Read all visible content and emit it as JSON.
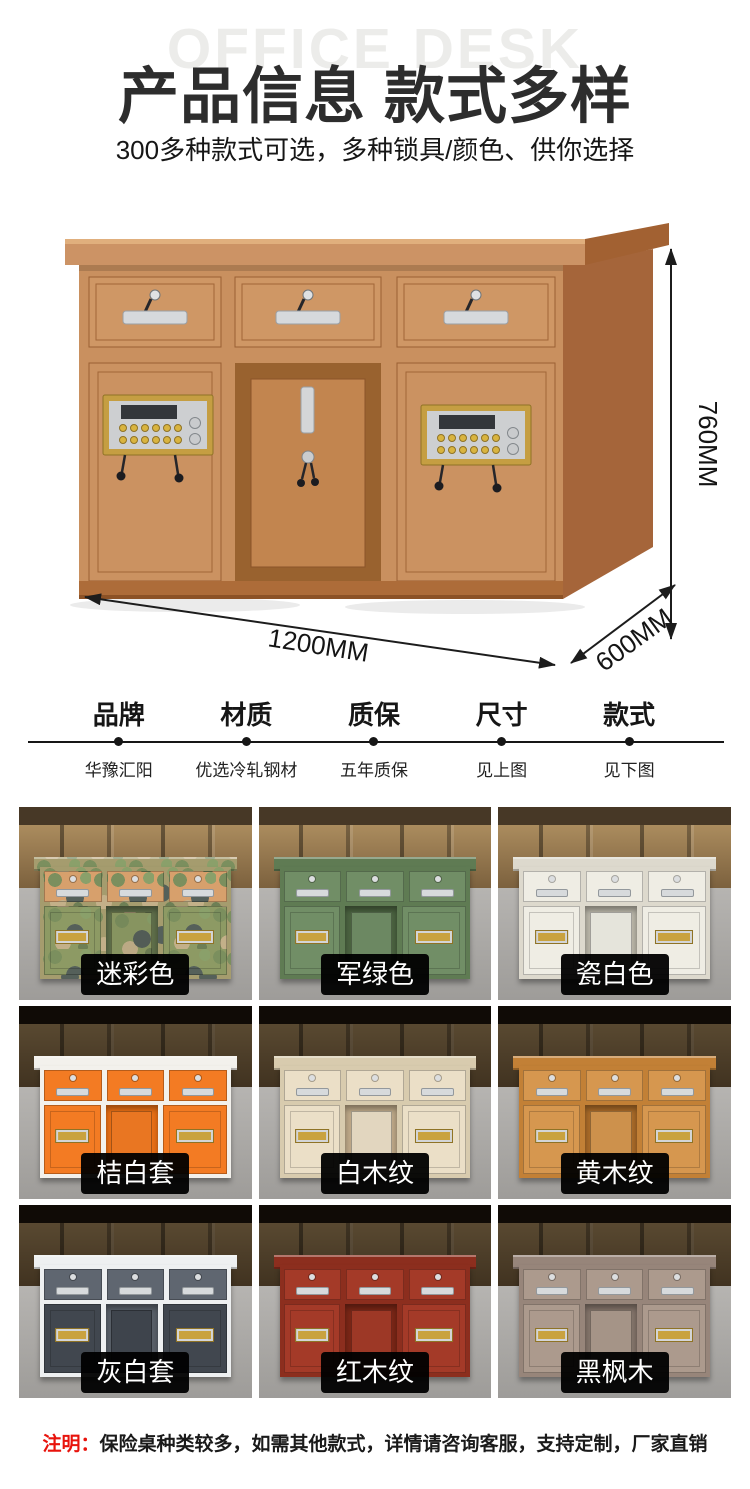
{
  "watermark": "OFFICE DESK",
  "header": {
    "title": "产品信息 款式多样",
    "subtitle": "300多种款式可选，多种锁具/颜色、供你选择"
  },
  "hero": {
    "height_label": "760MM",
    "width_label": "1200MM",
    "depth_label": "600MM"
  },
  "specs": [
    {
      "label": "品牌",
      "value": "华豫汇阳"
    },
    {
      "label": "材质",
      "value": "优选冷轧钢材"
    },
    {
      "label": "质保",
      "value": "五年质保"
    },
    {
      "label": "尺寸",
      "value": "见上图"
    },
    {
      "label": "款式",
      "value": "见下图"
    }
  ],
  "variants": [
    {
      "label": "迷彩色",
      "camo": true,
      "colors": {
        "frame": "#a59c6e",
        "drawer": "#d7a06c",
        "door": "#8d9a64",
        "inner": "#5f6e4a"
      }
    },
    {
      "label": "军绿色",
      "colors": {
        "frame": "#5f7b53",
        "drawer": "#718e66",
        "door": "#718e66",
        "inner": "#4b6340"
      }
    },
    {
      "label": "瓷白色",
      "colors": {
        "frame": "#ddd9cd",
        "drawer": "#efede4",
        "door": "#efede4",
        "inner": "#b9b5a8"
      }
    },
    {
      "label": "桔白套",
      "colors": {
        "frame": "#f3f1ec",
        "drawer": "#f37b23",
        "door": "#f37b23",
        "inner": "#e96f15"
      }
    },
    {
      "label": "白木纹",
      "colors": {
        "frame": "#d8cbae",
        "drawer": "#ebdfc7",
        "door": "#ebdfc7",
        "inner": "#bda888"
      }
    },
    {
      "label": "黄木纹",
      "colors": {
        "frame": "#c28036",
        "drawer": "#d6974f",
        "door": "#d6974f",
        "inner": "#a96a28"
      }
    },
    {
      "label": "灰白套",
      "colors": {
        "frame": "#eef0f1",
        "drawer": "#5f6670",
        "door": "#41474f",
        "inner": "#596069"
      }
    },
    {
      "label": "红木纹",
      "colors": {
        "frame": "#8c2e1e",
        "drawer": "#a43a28",
        "door": "#a43a28",
        "inner": "#7a2616"
      }
    },
    {
      "label": "黑枫木",
      "colors": {
        "frame": "#97857a",
        "drawer": "#ac9a8d",
        "door": "#ac9a8d",
        "inner": "#84746a"
      }
    }
  ],
  "note": {
    "prefix": "注明：",
    "text": "保险桌种类较多，如需其他款式，详情请咨询客服，支持定制，厂家直销"
  },
  "colors": {
    "accent_red": "#e8130c",
    "title_text": "#2d2d2d",
    "watermark_gray": "#ececea",
    "badge_bg": "#000000",
    "badge_text": "#ffffff",
    "hero_wood": "#c9905f"
  }
}
